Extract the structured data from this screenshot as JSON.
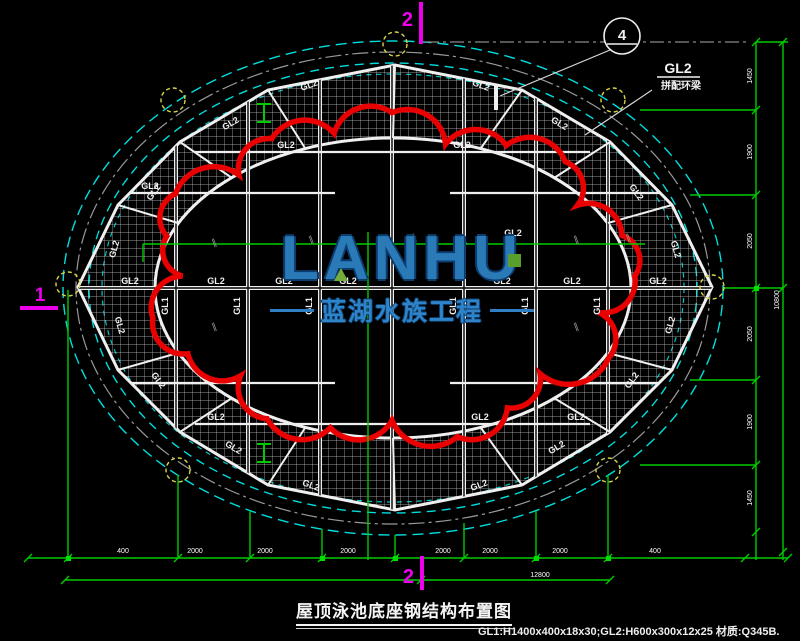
{
  "palette": {
    "background": "#000000",
    "pool_outline_cyan": "#00dede",
    "structure_white": "#efefef",
    "dimension_green": "#00cc00",
    "revision_cloud_red": "#e90000",
    "section_mark_magenta": "#ee00ee",
    "grid_bubble_yellow": "#d8d44a",
    "centerline_gray": "#8a8a8a",
    "watermark_blue": "#2a7ab8",
    "watermark_green": "#74ad3c"
  },
  "title": {
    "text": "屋顶泳池底座钢结构布置图"
  },
  "spec_note": "GL1:H1400x400x18x30;GL2:H600x300x12x25 材质:Q345B.",
  "watermark": {
    "word": "LANHU",
    "subtitle": "蓝湖水族工程"
  },
  "detail_bubble": {
    "number": "4"
  },
  "annotation": {
    "label": "GL2",
    "note": "拼配环梁"
  },
  "section_marks": {
    "top": "2",
    "bottom": "2",
    "left": "1"
  },
  "labels": {
    "gl1": "GL1",
    "gl2": "GL2",
    "break_mark": "∥"
  },
  "dims": {
    "bottom": [
      "400",
      "2000",
      "2000",
      "2000",
      "2000",
      "2000",
      "2000",
      "400"
    ],
    "bottom_total": "12800",
    "right": [
      "1450",
      "1900",
      "2050",
      "2050",
      "1900",
      "1450"
    ],
    "right_total": "10800"
  }
}
